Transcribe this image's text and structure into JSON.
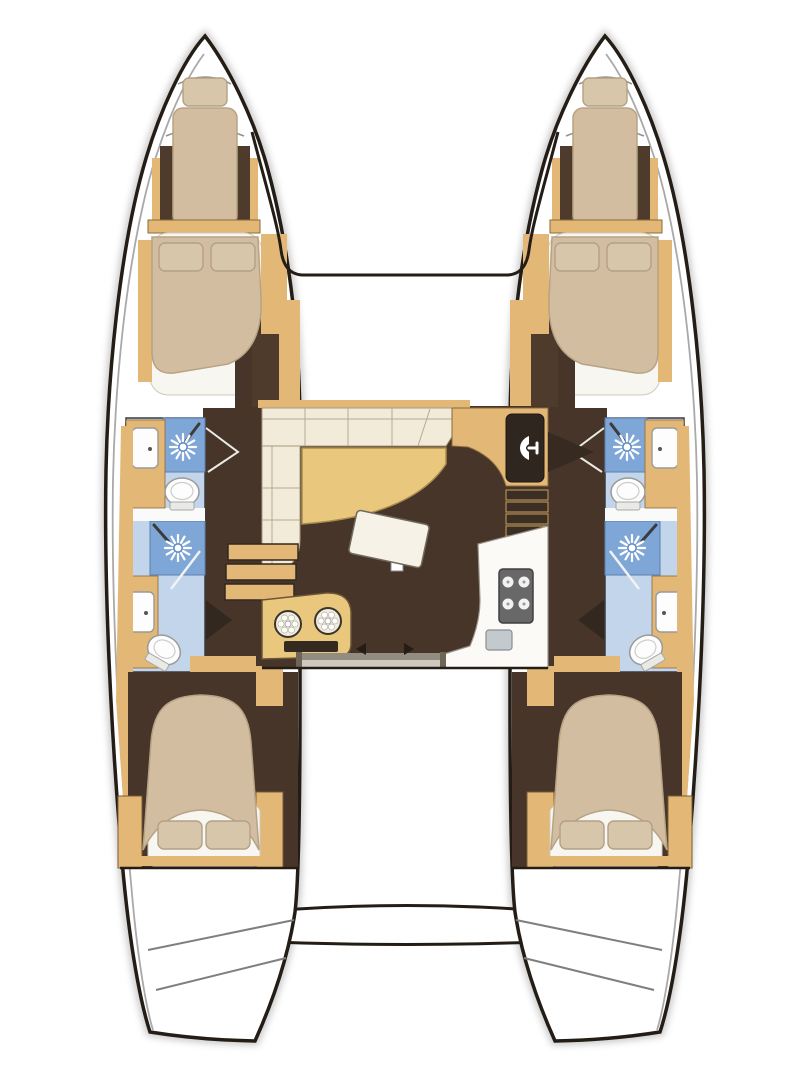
{
  "meta": {
    "type": "floor-plan",
    "subject": "catamaran sailing yacht accommodation plan",
    "orientation": "bow-up",
    "text_labels": []
  },
  "colors": {
    "outline": "#241d16",
    "hull_fill": "#ffffff",
    "deck_line": "#a9a9a9",
    "wood": "#e3b877",
    "wardrobe": "#4e3b2b",
    "floor": "#463528",
    "mattress": "#d2bda0",
    "pillow": "#dccdb2",
    "sheet": "#f8f6f1",
    "sofa": "#f2ebda",
    "table_wood": "#e9c87e",
    "table_white": "#f6f2e7",
    "bath_floor": "#c2d5ea",
    "shower": "#7ea6d6",
    "panel_dark": "#2f2620",
    "counter_white": "#fbfaf7",
    "stove": "#686868",
    "sink": "#c4c9cd",
    "slot": "#352a20",
    "door_wedge": "#33281f"
  },
  "legend": {
    "hulls": [
      {
        "id": "port",
        "rooms": [
          "forepeak berth",
          "forward double cabin",
          "forward head (shower, WC, sink)",
          "aft head (shower, WC, sink)",
          "aft double cabin"
        ]
      },
      {
        "id": "starboard",
        "rooms": [
          "forepeak berth",
          "forward double cabin",
          "forward head (shower, WC, sink)",
          "aft head (shower, WC, sink)",
          "aft double cabin"
        ]
      }
    ],
    "saloon": [
      "L-shaped sofa",
      "wood cocktail table",
      "tilted dining table",
      "chart cabinet with glass panel",
      "companionway stairs port",
      "companionway stairs starboard",
      "galley with 4-burner stove and sink",
      "instrument console with two dials",
      "aft sliding door"
    ],
    "exterior": [
      "bow trampoline outline",
      "aft platform step",
      "transom swim steps"
    ]
  },
  "fixture_counts": {
    "double_beds": 4,
    "forepeak_berths": 2,
    "showers": 4,
    "toilets": 4,
    "bathroom_sinks": 4,
    "galley_sinks": 1,
    "stove_burners": 4,
    "instrument_dials": 2
  }
}
